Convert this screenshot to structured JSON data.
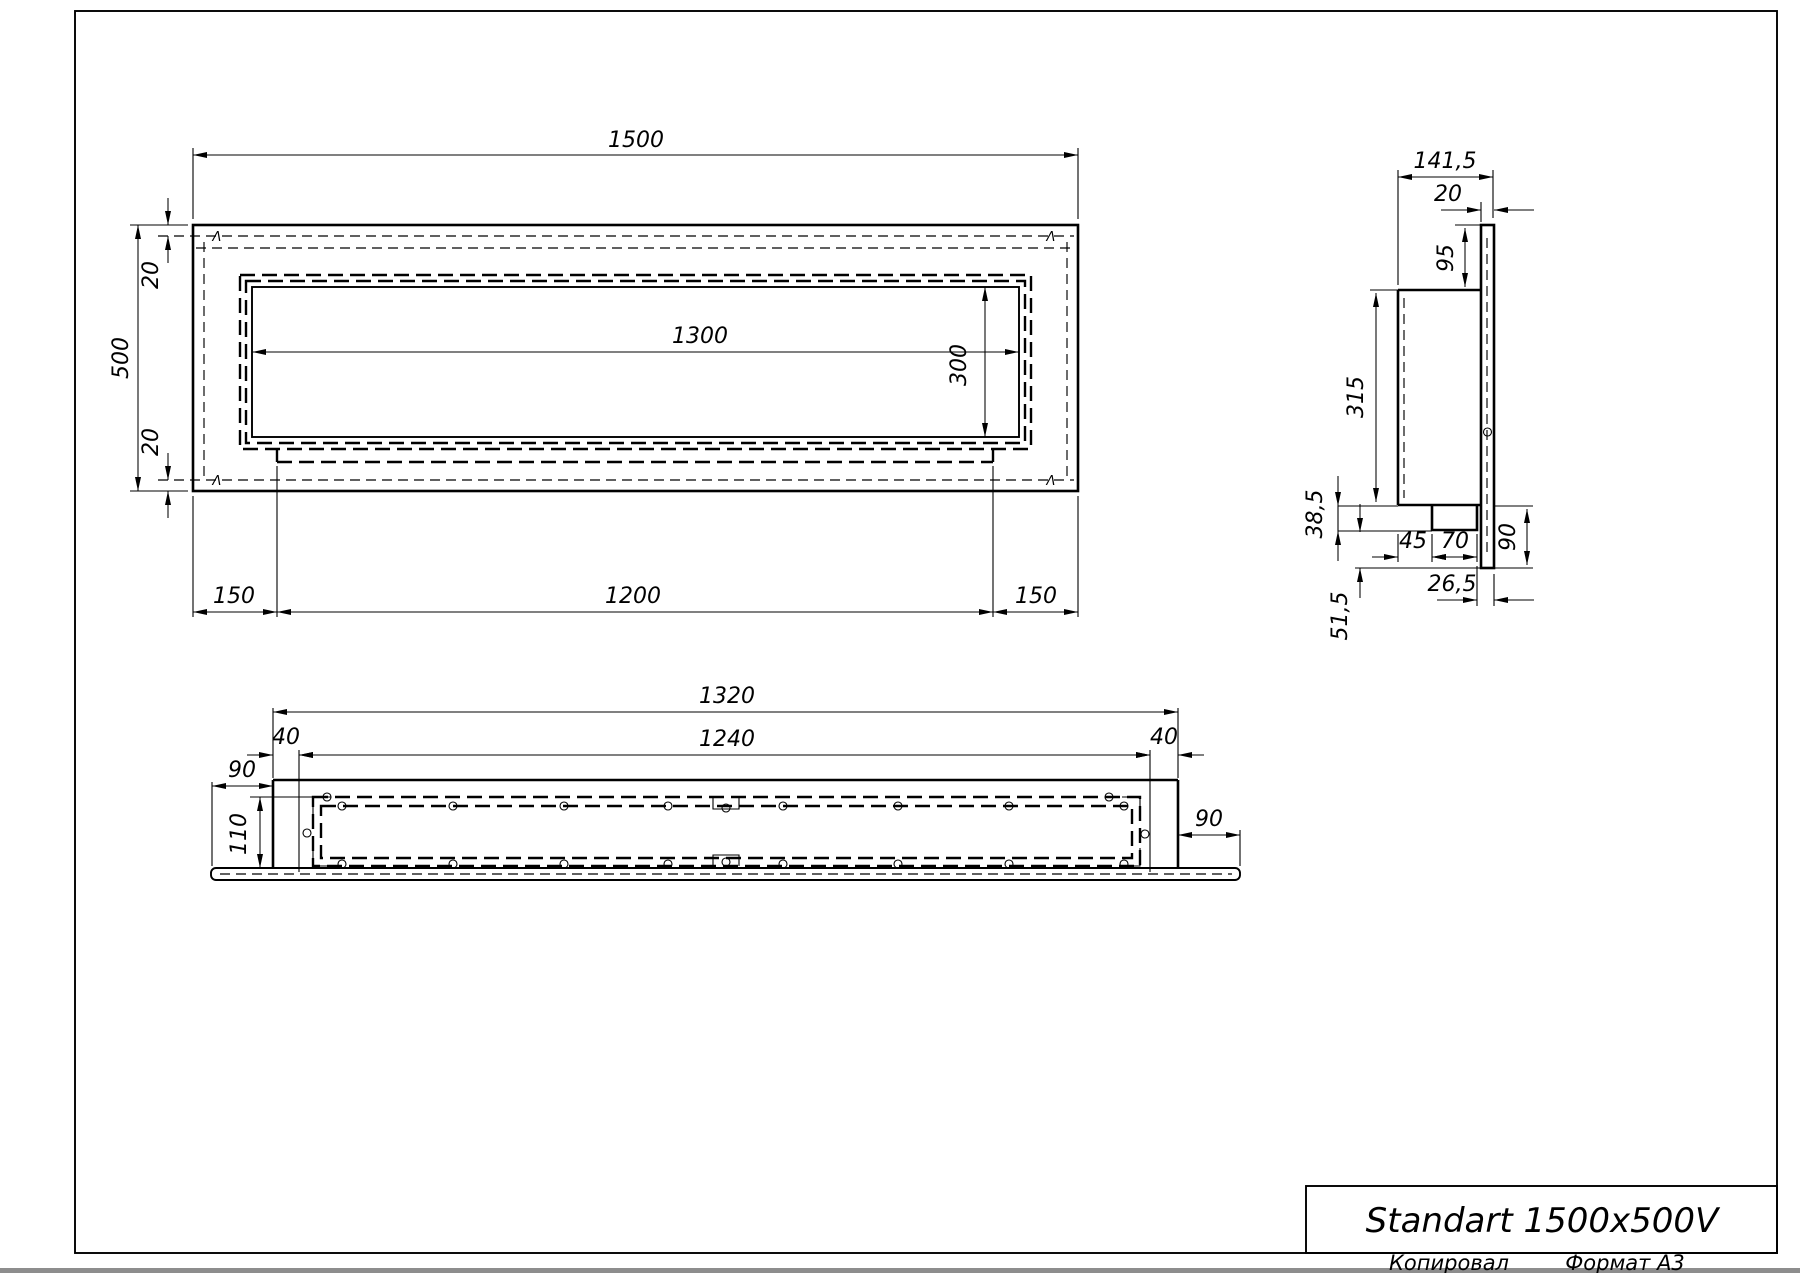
{
  "title_block": {
    "name": "Standart 1500x500V"
  },
  "footer": {
    "copied": "Копировал",
    "format": "Формат А3"
  },
  "front_view": {
    "marker": "Λ",
    "labels": {
      "total_width": "1500",
      "total_height": "500",
      "top_inset": "20",
      "bottom_inset": "20",
      "opening_width": "1300",
      "opening_height": "300",
      "left_offset": "150",
      "bottom_width": "1200",
      "right_offset": "150"
    }
  },
  "side_view": {
    "labels": {
      "depth": "141,5",
      "panel_thickness": "20",
      "top_to_box": "95",
      "box_height": "315",
      "box_to_tray": "38,5",
      "tray_to_bottom": "51,5",
      "block_offset": "45",
      "block_width": "70",
      "rear_offset": "26,5",
      "panel_below": "90"
    }
  },
  "bottom_view": {
    "labels": {
      "outer_width": "1320",
      "inner_width": "1240",
      "end_left": "40",
      "end_right": "40",
      "flange_left": "90",
      "flange_right": "90",
      "depth": "110"
    }
  }
}
